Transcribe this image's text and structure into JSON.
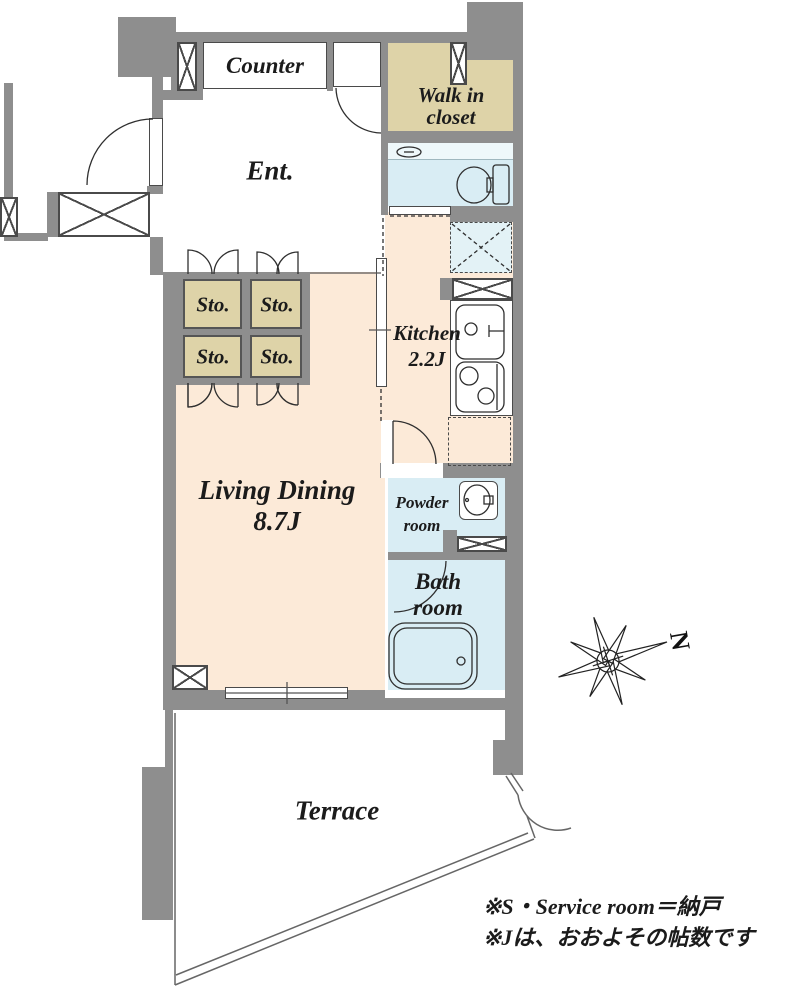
{
  "floorplan": {
    "rooms": {
      "counter": "Counter",
      "entrance": "Ent.",
      "walk_in_closet": [
        "Walk in",
        "closet"
      ],
      "storage_label": "Sto.",
      "kitchen": {
        "name": "Kitchen",
        "area": "2.2J"
      },
      "living_dining": {
        "name": "Living Dining",
        "area": "8.7J"
      },
      "powder_room": [
        "Powder",
        "room"
      ],
      "bath_room": [
        "Bath",
        "room"
      ],
      "terrace": "Terrace"
    },
    "compass": {
      "north": "N"
    },
    "legend": {
      "line1": "※S・Service room＝納戸",
      "line2": "※Jは、おおよその帖数です"
    },
    "colors": {
      "wall": "#8e8e8e",
      "living_floor": "#fcead8",
      "closet_storage": "#ded3a8",
      "wet_area": "#d9edf4",
      "hatch_area": "#e3f2f6",
      "linework": "#2f2f2f"
    }
  }
}
